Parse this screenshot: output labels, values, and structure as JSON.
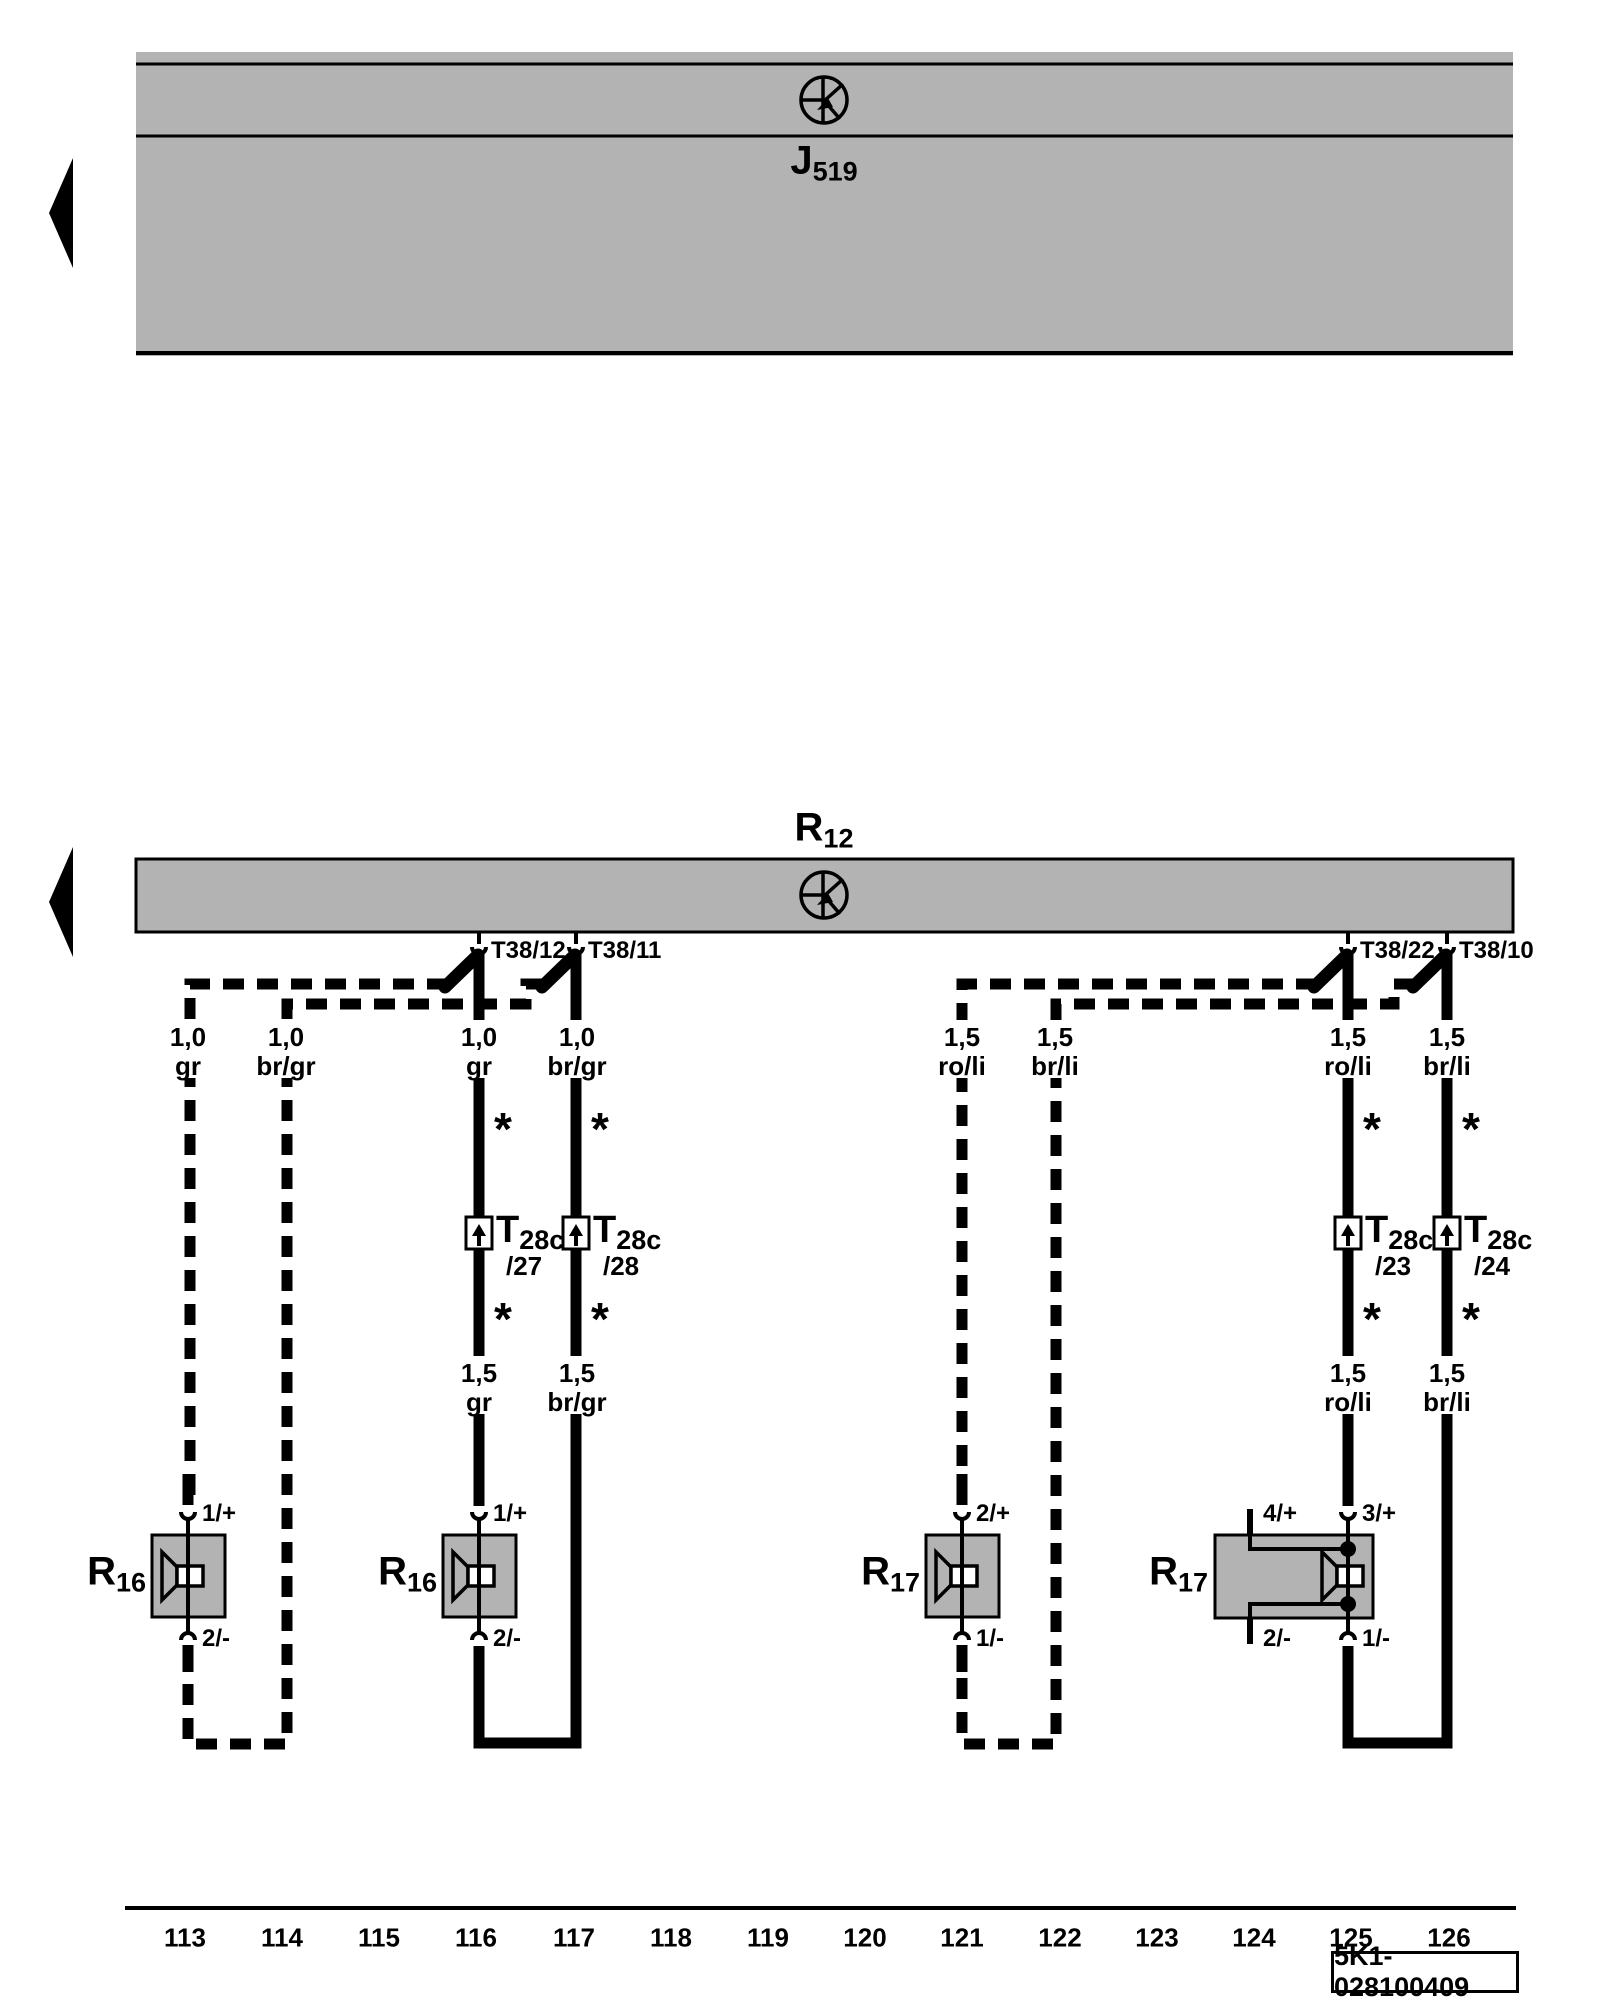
{
  "colors": {
    "box_fill": "#b3b3b3",
    "line": "#000000",
    "background": "#ffffff"
  },
  "footnote_mark": "*",
  "control_unit": {
    "name": "J",
    "sub": "519"
  },
  "amplifier": {
    "name": "R",
    "sub": "12"
  },
  "bar_pins": [
    "T38/12",
    "T38/11",
    "T38/22",
    "T38/10"
  ],
  "connectors": [
    {
      "name": "T",
      "sub": "28c",
      "pin": "/27"
    },
    {
      "name": "T",
      "sub": "28c",
      "pin": "/28"
    },
    {
      "name": "T",
      "sub": "28c",
      "pin": "/23"
    },
    {
      "name": "T",
      "sub": "28c",
      "pin": "/24"
    }
  ],
  "wire_labels_upper": [
    {
      "gauge": "1,0",
      "color": "gr"
    },
    {
      "gauge": "1,0",
      "color": "br/gr"
    },
    {
      "gauge": "1,0",
      "color": "gr"
    },
    {
      "gauge": "1,0",
      "color": "br/gr"
    },
    {
      "gauge": "1,5",
      "color": "ro/li"
    },
    {
      "gauge": "1,5",
      "color": "br/li"
    },
    {
      "gauge": "1,5",
      "color": "ro/li"
    },
    {
      "gauge": "1,5",
      "color": "br/li"
    }
  ],
  "wire_labels_lower": [
    {
      "gauge": "1,5",
      "color": "gr"
    },
    {
      "gauge": "1,5",
      "color": "br/gr"
    },
    {
      "gauge": "1,5",
      "color": "ro/li"
    },
    {
      "gauge": "1,5",
      "color": "br/li"
    }
  ],
  "speakers": [
    {
      "name": "R",
      "sub": "16",
      "pin_top": "1/+",
      "pin_bottom": "2/-"
    },
    {
      "name": "R",
      "sub": "16",
      "pin_top": "1/+",
      "pin_bottom": "2/-"
    },
    {
      "name": "R",
      "sub": "17",
      "pin_top": "2/+",
      "pin_bottom": "1/-"
    },
    {
      "name": "R",
      "sub": "17",
      "pin_top_left": "4/+",
      "pin_top_right": "3/+",
      "pin_bottom_left": "2/-",
      "pin_bottom_right": "1/-"
    }
  ],
  "track_ruler": {
    "numbers": [
      "113",
      "114",
      "115",
      "116",
      "117",
      "118",
      "119",
      "120",
      "121",
      "122",
      "123",
      "124",
      "125",
      "126"
    ]
  },
  "diagram_code": "5K1-028100409"
}
